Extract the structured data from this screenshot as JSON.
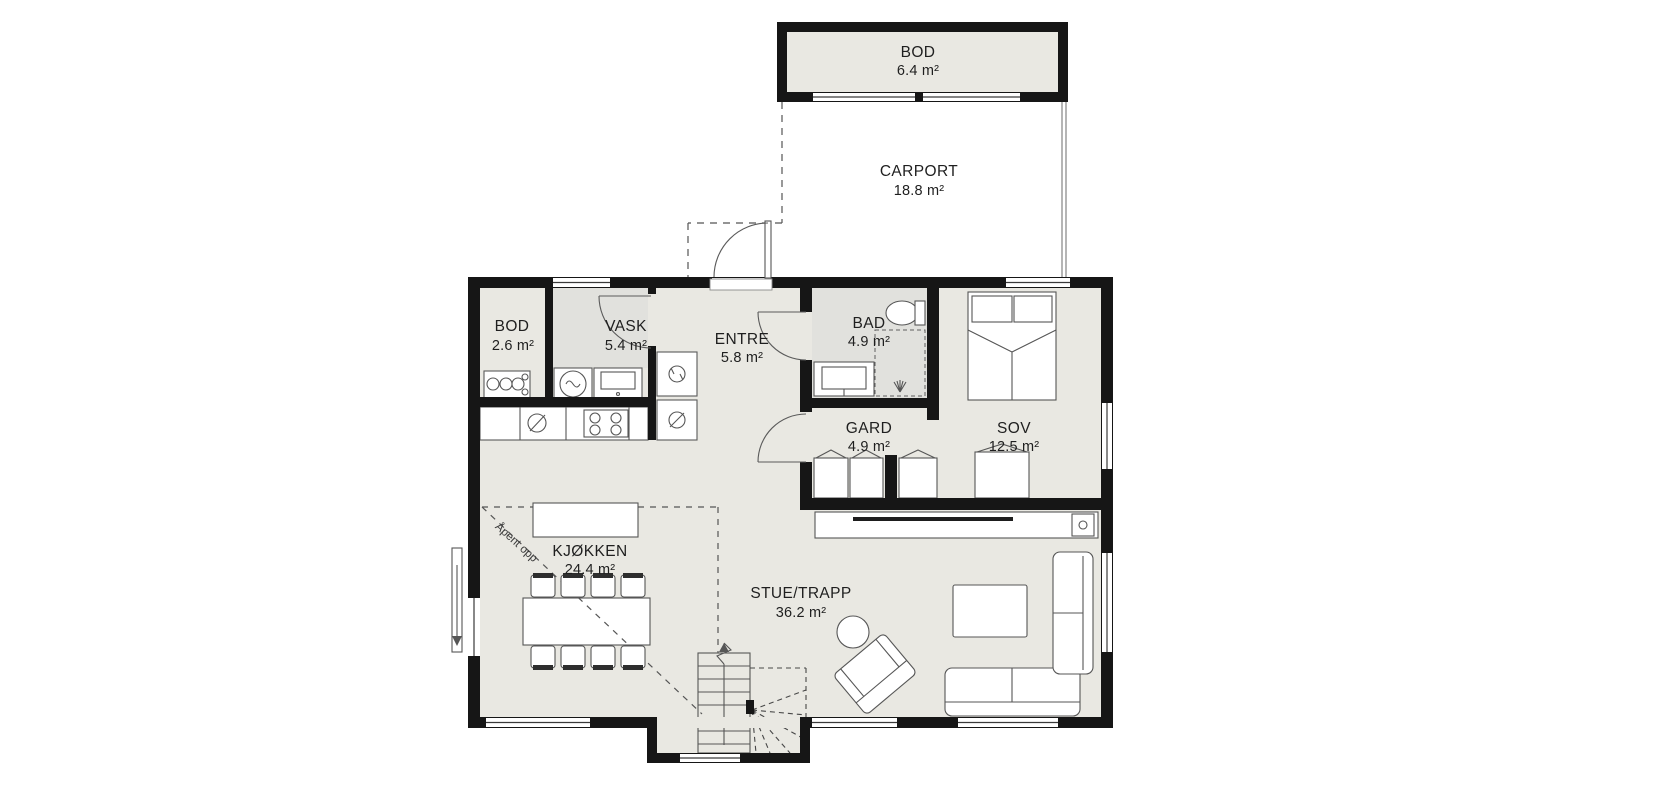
{
  "plan": {
    "rooms": {
      "bod_upper": {
        "name": "BOD",
        "area": "6.4 m²"
      },
      "carport": {
        "name": "CARPORT",
        "area": "18.8 m²"
      },
      "bod": {
        "name": "BOD",
        "area": "2.6 m²"
      },
      "vask": {
        "name": "VASK",
        "area": "5.4 m²"
      },
      "entre": {
        "name": "ENTRE",
        "area": "5.8 m²"
      },
      "bad": {
        "name": "BAD",
        "area": "4.9 m²"
      },
      "gard": {
        "name": "GARD",
        "area": "4.9 m²"
      },
      "sov": {
        "name": "SOV",
        "area": "12.5 m²"
      },
      "kjokken": {
        "name": "KJØKKEN",
        "area": "24.4 m²"
      },
      "stue": {
        "name": "STUE/TRAPP",
        "area": "36.2 m²"
      }
    },
    "annotations": {
      "open_to_above": "Åpent opp"
    },
    "colors": {
      "wall": "#161616",
      "floor": "#e9e8e2",
      "wet_floor": "#e1e1dd",
      "background": "#ffffff"
    }
  }
}
